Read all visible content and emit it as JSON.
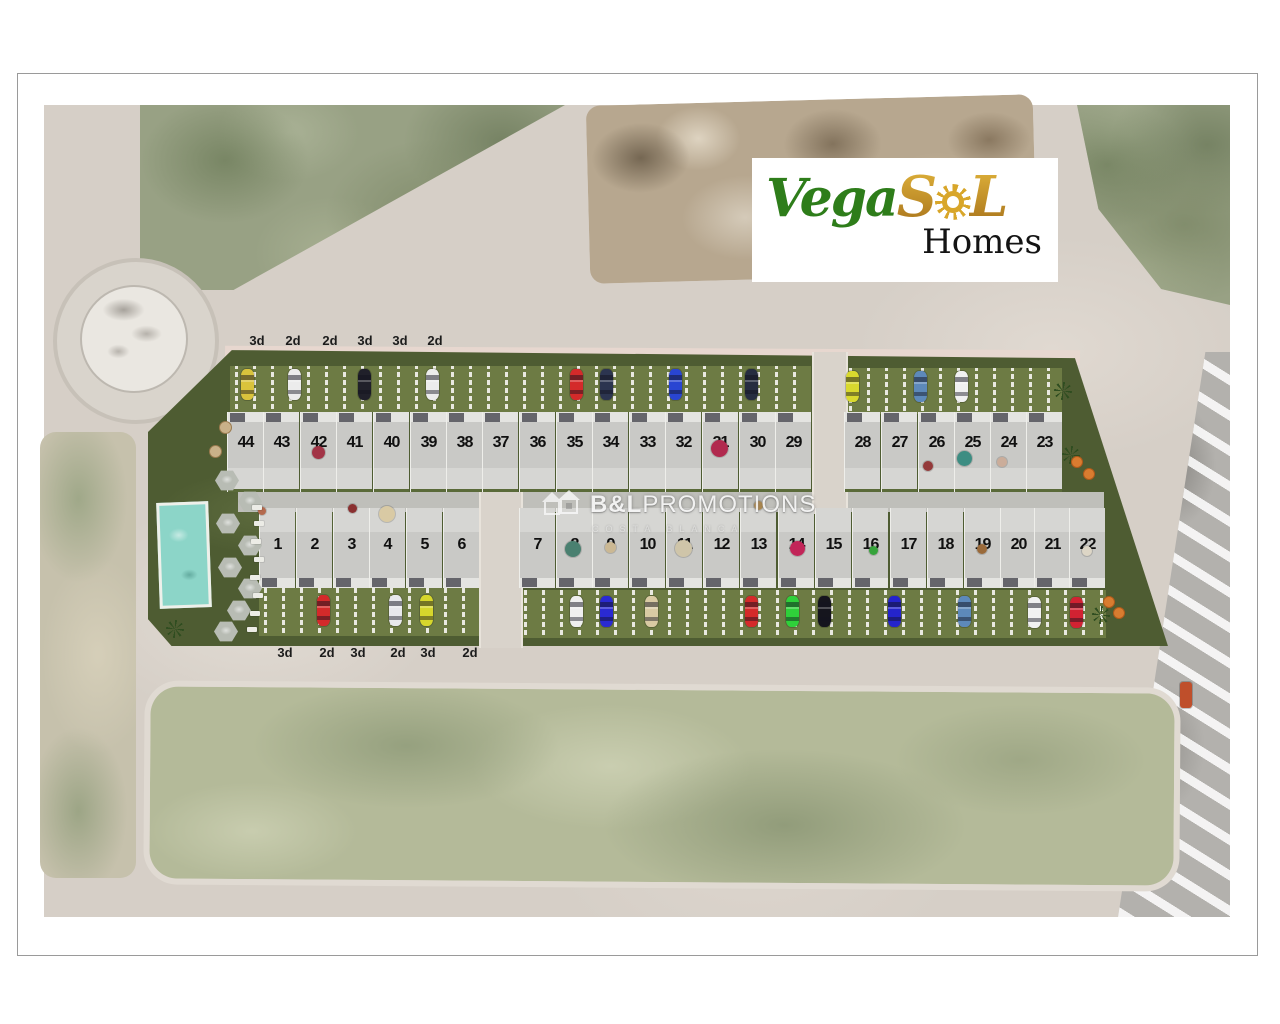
{
  "branding": {
    "logo": {
      "vega": "Vega",
      "s": "S",
      "l": "L",
      "homes": "Homes",
      "vega_color": "#2e7d1a",
      "gold_color": "#c9921c"
    },
    "watermark": {
      "title_bold": "B&L",
      "title_rest": "PROMOTIONS",
      "subtitle": "COSTA BLANCA",
      "icon": "double-house-icon"
    }
  },
  "site_plan": {
    "unit_type_labels_top": [
      {
        "t": "3d",
        "x": 257
      },
      {
        "t": "2d",
        "x": 293
      },
      {
        "t": "2d",
        "x": 330
      },
      {
        "t": "3d",
        "x": 365
      },
      {
        "t": "3d",
        "x": 400
      },
      {
        "t": "2d",
        "x": 435
      }
    ],
    "unit_type_labels_bottom": [
      {
        "t": "3d",
        "x": 285
      },
      {
        "t": "2d",
        "x": 327
      },
      {
        "t": "3d",
        "x": 358
      },
      {
        "t": "2d",
        "x": 398
      },
      {
        "t": "3d",
        "x": 428
      },
      {
        "t": "2d",
        "x": 470
      }
    ],
    "row_top": {
      "plots": [
        {
          "n": "44",
          "x": 245
        },
        {
          "n": "43",
          "x": 281
        },
        {
          "n": "42",
          "x": 318
        },
        {
          "n": "41",
          "x": 354
        },
        {
          "n": "40",
          "x": 391
        },
        {
          "n": "39",
          "x": 428
        },
        {
          "n": "38",
          "x": 464
        },
        {
          "n": "37",
          "x": 500
        },
        {
          "n": "36",
          "x": 537
        },
        {
          "n": "35",
          "x": 574
        },
        {
          "n": "34",
          "x": 610
        },
        {
          "n": "33",
          "x": 647
        },
        {
          "n": "32",
          "x": 683
        },
        {
          "n": "31",
          "x": 720
        },
        {
          "n": "30",
          "x": 757
        },
        {
          "n": "29",
          "x": 793
        },
        {
          "n": "28",
          "x": 862
        },
        {
          "n": "27",
          "x": 899
        },
        {
          "n": "26",
          "x": 936
        },
        {
          "n": "25",
          "x": 972
        },
        {
          "n": "24",
          "x": 1008
        },
        {
          "n": "23",
          "x": 1044
        }
      ]
    },
    "row_bottom": {
      "plots": [
        {
          "n": "1",
          "x": 277
        },
        {
          "n": "2",
          "x": 314
        },
        {
          "n": "3",
          "x": 351
        },
        {
          "n": "4",
          "x": 387
        },
        {
          "n": "5",
          "x": 424
        },
        {
          "n": "6",
          "x": 461
        },
        {
          "n": "7",
          "x": 537
        },
        {
          "n": "8",
          "x": 574
        },
        {
          "n": "9",
          "x": 610
        },
        {
          "n": "10",
          "x": 647
        },
        {
          "n": "11",
          "x": 684
        },
        {
          "n": "12",
          "x": 721
        },
        {
          "n": "13",
          "x": 758
        },
        {
          "n": "14",
          "x": 796
        },
        {
          "n": "15",
          "x": 833
        },
        {
          "n": "16",
          "x": 870
        },
        {
          "n": "17",
          "x": 908
        },
        {
          "n": "18",
          "x": 945
        },
        {
          "n": "19",
          "x": 982
        },
        {
          "n": "20",
          "x": 1018
        },
        {
          "n": "21",
          "x": 1052
        },
        {
          "n": "22",
          "x": 1087
        }
      ]
    },
    "cars": [
      {
        "x": 248,
        "y": 369,
        "c": "#d9c33c"
      },
      {
        "x": 295,
        "y": 369,
        "c": "#ececec"
      },
      {
        "x": 365,
        "y": 369,
        "c": "#20202a"
      },
      {
        "x": 433,
        "y": 369,
        "c": "#ececec"
      },
      {
        "x": 577,
        "y": 369,
        "c": "#d42a2a"
      },
      {
        "x": 607,
        "y": 369,
        "c": "#2c3550"
      },
      {
        "x": 676,
        "y": 369,
        "c": "#2945d2"
      },
      {
        "x": 752,
        "y": 369,
        "c": "#262d40"
      },
      {
        "x": 853,
        "y": 371,
        "c": "#d9d92e"
      },
      {
        "x": 921,
        "y": 371,
        "c": "#5d89ba"
      },
      {
        "x": 962,
        "y": 371,
        "c": "#f0f0f0"
      },
      {
        "x": 324,
        "y": 595,
        "c": "#d42a2a"
      },
      {
        "x": 396,
        "y": 595,
        "c": "#e8e8ec"
      },
      {
        "x": 427,
        "y": 595,
        "c": "#d6d62c"
      },
      {
        "x": 577,
        "y": 596,
        "c": "#efefef"
      },
      {
        "x": 607,
        "y": 596,
        "c": "#2a2ad2"
      },
      {
        "x": 652,
        "y": 596,
        "c": "#d9caa3"
      },
      {
        "x": 752,
        "y": 596,
        "c": "#d42a2a"
      },
      {
        "x": 793,
        "y": 596,
        "c": "#2fd03a"
      },
      {
        "x": 825,
        "y": 596,
        "c": "#15151d"
      },
      {
        "x": 895,
        "y": 596,
        "c": "#2424cc"
      },
      {
        "x": 965,
        "y": 596,
        "c": "#5d89ba"
      },
      {
        "x": 1035,
        "y": 597,
        "c": "#f1f1f1"
      },
      {
        "x": 1077,
        "y": 597,
        "c": "#d22232"
      }
    ],
    "street_van": {
      "x": 1186,
      "y": 682,
      "c": "#bf4f2b"
    },
    "garden_props": [
      {
        "x": 318,
        "y": 452,
        "c": "#a23446",
        "s": 13
      },
      {
        "x": 719,
        "y": 448,
        "c": "#b12a4e",
        "s": 17
      },
      {
        "x": 964,
        "y": 458,
        "c": "#3d8d82",
        "s": 15
      },
      {
        "x": 1002,
        "y": 462,
        "c": "#cbad9a",
        "s": 10
      },
      {
        "x": 928,
        "y": 466,
        "c": "#943a3a",
        "s": 10
      },
      {
        "x": 758,
        "y": 505,
        "c": "#b08a4e",
        "s": 9
      },
      {
        "x": 387,
        "y": 514,
        "c": "#d9caa4",
        "s": 16
      },
      {
        "x": 352,
        "y": 508,
        "c": "#8a3030",
        "s": 9
      },
      {
        "x": 262,
        "y": 511,
        "c": "#b46a4e",
        "s": 8
      },
      {
        "x": 573,
        "y": 549,
        "c": "#4a8070",
        "s": 16
      },
      {
        "x": 610,
        "y": 547,
        "c": "#cbb893",
        "s": 11
      },
      {
        "x": 683,
        "y": 548,
        "c": "#cfc5a9",
        "s": 17
      },
      {
        "x": 797,
        "y": 548,
        "c": "#c22558",
        "s": 15
      },
      {
        "x": 873,
        "y": 550,
        "c": "#36a33a",
        "s": 9
      },
      {
        "x": 982,
        "y": 549,
        "c": "#9a6a3a",
        "s": 10
      },
      {
        "x": 1087,
        "y": 551,
        "c": "#ddd6c6",
        "s": 10
      }
    ],
    "amenities": {
      "pool": "swimming-pool",
      "hex_parasols": [
        {
          "x": 215,
          "y": 470
        },
        {
          "x": 238,
          "y": 491
        },
        {
          "x": 216,
          "y": 513
        },
        {
          "x": 238,
          "y": 535
        },
        {
          "x": 218,
          "y": 557
        },
        {
          "x": 238,
          "y": 578
        },
        {
          "x": 227,
          "y": 600
        },
        {
          "x": 214,
          "y": 621
        }
      ],
      "loungers": [
        {
          "x": 252,
          "y": 505
        },
        {
          "x": 254,
          "y": 521
        },
        {
          "x": 251,
          "y": 539
        },
        {
          "x": 254,
          "y": 557
        },
        {
          "x": 250,
          "y": 575
        },
        {
          "x": 253,
          "y": 593
        },
        {
          "x": 250,
          "y": 611
        },
        {
          "x": 247,
          "y": 627
        }
      ],
      "round_tables": [
        {
          "x": 219,
          "y": 421
        },
        {
          "x": 209,
          "y": 445
        }
      ],
      "palm_trees": [
        {
          "x": 166,
          "y": 620
        },
        {
          "x": 1054,
          "y": 382
        },
        {
          "x": 1062,
          "y": 446
        },
        {
          "x": 1092,
          "y": 606
        }
      ],
      "orange_parasols": [
        {
          "x": 1071,
          "y": 456
        },
        {
          "x": 1083,
          "y": 468
        },
        {
          "x": 1103,
          "y": 596
        },
        {
          "x": 1113,
          "y": 607
        }
      ]
    }
  }
}
